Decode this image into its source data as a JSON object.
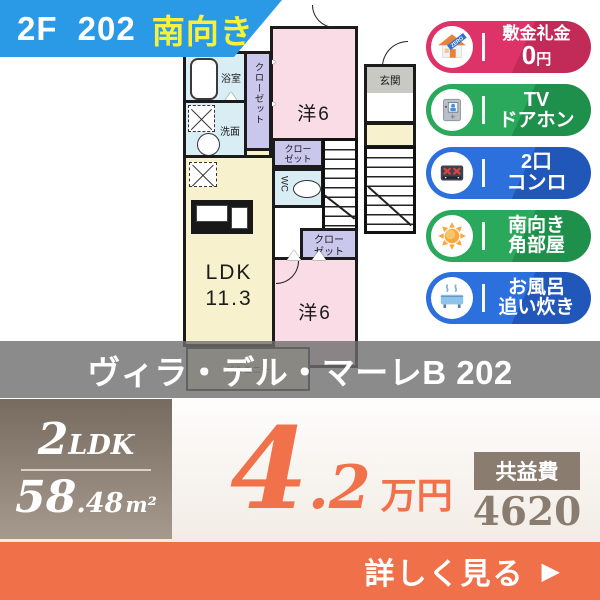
{
  "banner": {
    "unit": "2F 202",
    "facing": "南向き",
    "bg_color": "#2a9ae6",
    "facing_color": "#f7f13c"
  },
  "floorplan": {
    "bath_label": "浴室",
    "closet_vertical_label": "クローゼット",
    "washroom_label": "洗面",
    "room1_label": "洋6",
    "ldk_label_line1": "LDK",
    "ldk_label_line2": "11.3",
    "closet2_line1": "クロー",
    "closet2_line2": "ゼット",
    "closet3_line1": "クロー",
    "closet3_line2": "ゼット",
    "wc_label": "WC",
    "room2_label": "洋6",
    "entrance_label": "玄関",
    "balcony_label": "バルコニー"
  },
  "badges": [
    {
      "line1": "敷金礼金",
      "line2_value": "0",
      "line2_unit": "円",
      "icon": "zero-house",
      "icon_text": "ZERO",
      "color": "#dd3368",
      "color_dark": "#c22a58"
    },
    {
      "line1": "TV",
      "line2": "ドアホン",
      "icon": "tv-doorphone",
      "color": "#2aa85c",
      "color_dark": "#1f8f4c"
    },
    {
      "line1": "2口",
      "line2": "コンロ",
      "icon": "stove",
      "color": "#2b70dd",
      "color_dark": "#2257ba"
    },
    {
      "line1": "南向き",
      "line2": "角部屋",
      "icon": "sun",
      "color": "#2aa85c",
      "color_dark": "#1f8f4c"
    },
    {
      "line1": "お風呂",
      "line2": "追い炊き",
      "icon": "bathtub",
      "color": "#2b70dd",
      "color_dark": "#2257ba"
    }
  ],
  "title": "ヴィラ・デル・マーレB 202",
  "specs": {
    "layout_value": "2",
    "layout_type": "LDK",
    "area_value": "58",
    "area_decimal": ".48",
    "area_unit": "m²"
  },
  "price": {
    "value_int": "4",
    "value_dec": ".2",
    "unit": "万円",
    "color": "#f0714a"
  },
  "fee": {
    "label": "共益費",
    "value": "4620",
    "unit": "円"
  },
  "cta": {
    "label": "詳しく見る",
    "arrow": "▶"
  }
}
